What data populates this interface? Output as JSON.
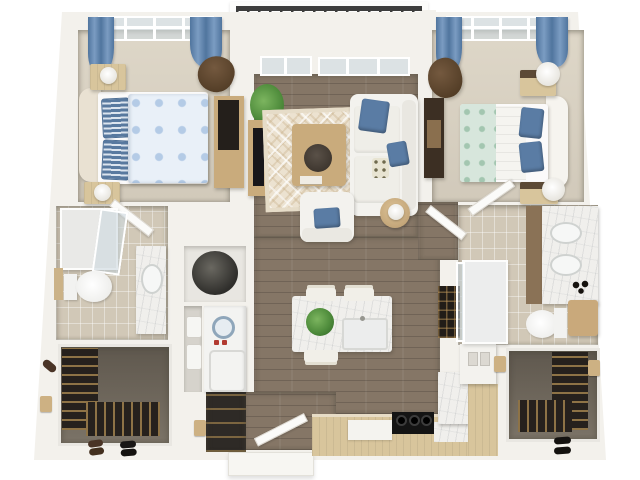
{
  "scene": {
    "type": "3d-floor-plan-render",
    "description": "Isometric 3D floor plan of a two-bedroom, two-bathroom apartment with central living room, kitchen island, balcony, two walk-in closets, laundry closet and entry"
  },
  "labels": {
    "plan": "apartment 3D floor plan",
    "balcony": "balcony",
    "bedroom1": "bedroom 1",
    "bedroom2": "bedroom 2",
    "living_room": "living room",
    "kitchen": "kitchen",
    "bathroom1": "bathroom 1",
    "bathroom2": "bathroom 2",
    "closet1": "walk-in closet 1",
    "closet2": "walk-in closet 2",
    "laundry": "laundry and utility closet",
    "coat_closet": "coat closet",
    "entry": "entry foyer"
  },
  "palette": {
    "wall": "#f3f1ec",
    "wallShade": "#dbd7d0",
    "carpet": "#d7cfc0",
    "wood": "#857666",
    "tile": "#d1c8b7",
    "rug": "#ece2d0",
    "blue": "#5a7ca4",
    "blueLight": "#dde7f3",
    "teal": "#d7e6dc",
    "marble": "#f0efec",
    "tan": "#d8c59c",
    "furnWood": "#c9ab7c",
    "brown": "#54412f",
    "railing": "#3d3d3d",
    "plant": "#4f8c3c",
    "closetFloor": "#746c60",
    "dark": "#26211d",
    "white": "#fafaf8",
    "glass": "#ccd8df"
  }
}
